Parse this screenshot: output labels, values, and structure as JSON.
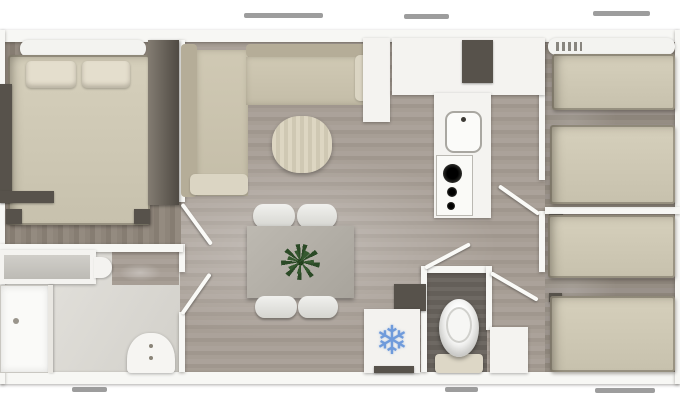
{
  "meta": {
    "description": "Top-down 3D rendered floor plan of a 3-bedroom mobile home",
    "image_kind": "floorplan-render"
  },
  "palette": {
    "wall": "#f7f7f4",
    "floor_wood_light": "#a79e95",
    "floor_wood_master": "#8e857a",
    "floor_wood_right": "#958d83",
    "floor_bathroom": "#e0ded9",
    "floor_wc_dark": "#6b6660",
    "bed_beige": "#d2ccb8",
    "dark_furniture": "#57524b",
    "white_furniture": "#f4f3f0",
    "accent_snowflake_blue": "#6f9bdb",
    "plant_green": "#2e4d2a",
    "window_mark_gray": "#8c8c8c"
  },
  "fridge": {
    "snowflake_glyph": "❄"
  },
  "floorplan": {
    "width": 680,
    "height": 408,
    "rooms": [
      "master-bedroom",
      "bathroom",
      "living-room",
      "dining-area",
      "kitchen",
      "hallway",
      "wc",
      "bedroom-top-right",
      "bedroom-bottom-right"
    ],
    "items": [
      {
        "name": "floor-main-living",
        "cls": "floor-living",
        "x": 5,
        "y": 40,
        "w": 670,
        "h": 332
      },
      {
        "name": "floor-master-bedroom",
        "cls": "floor-master",
        "x": 5,
        "y": 40,
        "w": 176,
        "h": 204
      },
      {
        "name": "floor-bedroom-top-right",
        "cls": "floor-right",
        "x": 545,
        "y": 40,
        "w": 130,
        "h": 168
      },
      {
        "name": "floor-bedroom-bottom-right",
        "cls": "floor-right",
        "x": 545,
        "y": 213,
        "w": 130,
        "h": 159
      },
      {
        "name": "floor-bathroom",
        "cls": "floor-bath",
        "x": 5,
        "y": 251,
        "w": 175,
        "h": 121
      },
      {
        "name": "floor-bathroom-door-patch",
        "cls": "floor-living",
        "x": 112,
        "y": 252,
        "w": 67,
        "h": 33
      },
      {
        "name": "floor-wc",
        "cls": "floor-wc",
        "x": 427,
        "y": 272,
        "w": 60,
        "h": 100
      },
      {
        "name": "wall-top-exterior",
        "cls": "wall",
        "x": 0,
        "y": 30,
        "w": 680,
        "h": 12
      },
      {
        "name": "wall-bottom-exterior",
        "cls": "wall",
        "x": 0,
        "y": 372,
        "w": 680,
        "h": 12
      },
      {
        "name": "wall-left-exterior",
        "cls": "wall",
        "x": 0,
        "y": 30,
        "w": 5,
        "h": 354
      },
      {
        "name": "wall-right-exterior",
        "cls": "wall",
        "x": 675,
        "y": 30,
        "w": 5,
        "h": 354
      },
      {
        "name": "wall-master-hall-upper",
        "cls": "wall",
        "x": 179,
        "y": 40,
        "w": 6,
        "h": 162
      },
      {
        "name": "wall-master-hall-mid",
        "cls": "wall",
        "x": 179,
        "y": 244,
        "w": 6,
        "h": 28
      },
      {
        "name": "wall-master-hall-lower",
        "cls": "wall",
        "x": 179,
        "y": 312,
        "w": 6,
        "h": 60
      },
      {
        "name": "wall-bedroom-bathroom",
        "cls": "wall",
        "x": 0,
        "y": 244,
        "w": 183,
        "h": 8
      },
      {
        "name": "wall-wc-top",
        "cls": "wall",
        "x": 421,
        "y": 266,
        "w": 70,
        "h": 7
      },
      {
        "name": "wall-wc-left",
        "cls": "wall",
        "x": 421,
        "y": 266,
        "w": 6,
        "h": 106
      },
      {
        "name": "wall-wc-right",
        "cls": "wall",
        "x": 486,
        "y": 266,
        "w": 6,
        "h": 64
      },
      {
        "name": "wall-kitchen-bedroom-upper",
        "cls": "wall",
        "x": 539,
        "y": 40,
        "w": 6,
        "h": 140
      },
      {
        "name": "wall-hall-bedroom-mid",
        "cls": "wall",
        "x": 539,
        "y": 211,
        "w": 6,
        "h": 61
      },
      {
        "name": "wall-between-right-bedrooms",
        "cls": "wall",
        "x": 545,
        "y": 207,
        "w": 135,
        "h": 7
      },
      {
        "name": "master-bed-headboard",
        "cls": "shelf",
        "x": 20,
        "y": 40,
        "w": 126,
        "h": 17
      },
      {
        "name": "master-double-bed",
        "cls": "bed",
        "x": 8,
        "y": 55,
        "w": 142,
        "h": 170
      },
      {
        "name": "master-pillow-left",
        "cls": "pillow",
        "x": 26,
        "y": 61,
        "w": 50,
        "h": 27
      },
      {
        "name": "master-pillow-right",
        "cls": "pillow",
        "x": 82,
        "y": 61,
        "w": 48,
        "h": 27
      },
      {
        "name": "master-bed-post-left",
        "cls": "darkunit",
        "x": 6,
        "y": 209,
        "w": 16,
        "h": 15
      },
      {
        "name": "master-bed-post-right",
        "cls": "darkunit",
        "x": 134,
        "y": 209,
        "w": 16,
        "h": 15
      },
      {
        "name": "master-wardrobe",
        "cls": "wardrobe",
        "x": 148,
        "y": 40,
        "w": 31,
        "h": 165
      },
      {
        "name": "master-side-unit",
        "cls": "darkunit",
        "x": 0,
        "y": 84,
        "w": 12,
        "h": 118
      },
      {
        "name": "master-bench",
        "cls": "darkunit",
        "x": 0,
        "y": 191,
        "w": 54,
        "h": 12
      },
      {
        "name": "bathroom-vanity",
        "cls": "white-furn",
        "x": 0,
        "y": 250,
        "w": 96,
        "h": 34
      },
      {
        "name": "bathroom-vanity-top",
        "cls": "counter-top",
        "x": 4,
        "y": 255,
        "w": 86,
        "h": 24
      },
      {
        "name": "bathroom-washbasin-bump",
        "cls": "bump",
        "x": 94,
        "y": 257,
        "w": 18,
        "h": 21
      },
      {
        "name": "shower-tray",
        "cls": "shower",
        "x": 0,
        "y": 285,
        "w": 50,
        "h": 88
      },
      {
        "name": "shower-screen",
        "cls": "screenline",
        "x": 48,
        "y": 285,
        "w": 5,
        "h": 88
      },
      {
        "name": "shower-drain",
        "cls": "dot",
        "x": 13,
        "y": 318,
        "w": 6,
        "h": 6
      },
      {
        "name": "entrance-door-arch",
        "cls": "arch",
        "x": 127,
        "y": 333,
        "w": 48,
        "h": 40
      },
      {
        "name": "sofa-left-backrest",
        "cls": "sofa-back",
        "x": 181,
        "y": 44,
        "w": 16,
        "h": 153
      },
      {
        "name": "sofa-left-seat",
        "cls": "sofa-seat",
        "x": 197,
        "y": 50,
        "w": 51,
        "h": 146
      },
      {
        "name": "sofa-left-armrest",
        "cls": "sofa-arm",
        "x": 190,
        "y": 174,
        "w": 58,
        "h": 21
      },
      {
        "name": "sofa-top-backrest",
        "cls": "sofa-back",
        "x": 246,
        "y": 44,
        "w": 122,
        "h": 13
      },
      {
        "name": "sofa-top-seat",
        "cls": "sofa-seat",
        "x": 246,
        "y": 57,
        "w": 122,
        "h": 48
      },
      {
        "name": "sofa-end-cushion",
        "cls": "sofa-arm",
        "x": 355,
        "y": 55,
        "w": 29,
        "h": 46
      },
      {
        "name": "pantry-cabinet",
        "cls": "white-furn",
        "x": 363,
        "y": 38,
        "w": 27,
        "h": 84
      },
      {
        "name": "pouf-side-table",
        "cls": "pouf",
        "x": 272,
        "y": 116,
        "w": 60,
        "h": 57
      },
      {
        "name": "dining-chair-top-left",
        "cls": "chair",
        "x": 253,
        "y": 204,
        "w": 42,
        "h": 24
      },
      {
        "name": "dining-chair-top-right",
        "cls": "chair",
        "x": 297,
        "y": 204,
        "w": 40,
        "h": 24
      },
      {
        "name": "dining-table",
        "cls": "table",
        "x": 247,
        "y": 226,
        "w": 107,
        "h": 72
      },
      {
        "name": "plant-centerpiece",
        "cls": "plant",
        "x": 283,
        "y": 246,
        "w": 35,
        "h": 32
      },
      {
        "name": "dining-chair-bottom-left",
        "cls": "chair",
        "x": 255,
        "y": 296,
        "w": 42,
        "h": 22
      },
      {
        "name": "dining-chair-bottom-right",
        "cls": "chair",
        "x": 298,
        "y": 296,
        "w": 40,
        "h": 22
      },
      {
        "name": "kitchen-wall-cabinets",
        "cls": "white-furn",
        "x": 392,
        "y": 38,
        "w": 153,
        "h": 57
      },
      {
        "name": "kitchen-appliance",
        "cls": "darkunit",
        "x": 462,
        "y": 40,
        "w": 31,
        "h": 43
      },
      {
        "name": "kitchen-counter",
        "cls": "white-furn",
        "x": 434,
        "y": 93,
        "w": 57,
        "h": 125
      },
      {
        "name": "kitchen-sink",
        "cls": "sink",
        "x": 445,
        "y": 111,
        "w": 37,
        "h": 42
      },
      {
        "name": "kitchen-hob",
        "cls": "hob",
        "x": 436,
        "y": 155,
        "w": 37,
        "h": 61
      },
      {
        "name": "hob-burner-large",
        "cls": "burner",
        "x": 443,
        "y": 164,
        "w": 19,
        "h": 19
      },
      {
        "name": "hob-burner-medium",
        "cls": "burner",
        "x": 447,
        "y": 187,
        "w": 10,
        "h": 10
      },
      {
        "name": "hob-burner-small",
        "cls": "burner",
        "x": 447,
        "y": 202,
        "w": 8,
        "h": 8
      },
      {
        "name": "wc-side-cabinet",
        "cls": "darkunit",
        "x": 394,
        "y": 284,
        "w": 32,
        "h": 27
      },
      {
        "name": "fridge",
        "cls": "fridge",
        "x": 364,
        "y": 309,
        "w": 56,
        "h": 64,
        "glyph_bind": "fridge.snowflake_glyph",
        "glyph_name": "snowflake-icon"
      },
      {
        "name": "fridge-base-strip",
        "cls": "darkunit",
        "x": 374,
        "y": 366,
        "w": 40,
        "h": 7
      },
      {
        "name": "toilet-base",
        "cls": "toilet-base",
        "x": 435,
        "y": 354,
        "w": 48,
        "h": 19
      },
      {
        "name": "toilet",
        "cls": "toilet",
        "x": 439,
        "y": 299,
        "w": 40,
        "h": 58
      },
      {
        "name": "hall-storage-cabinet",
        "cls": "white-furn",
        "x": 490,
        "y": 327,
        "w": 38,
        "h": 46
      },
      {
        "name": "right-bedroom-shelf",
        "cls": "shelf",
        "x": 548,
        "y": 38,
        "w": 127,
        "h": 17
      },
      {
        "name": "right-bedroom-shelf-marks",
        "cls": "mark",
        "x": 556,
        "y": 42,
        "w": 26,
        "h": 9
      },
      {
        "name": "bed-single-top-1",
        "cls": "bed",
        "x": 552,
        "y": 54,
        "w": 123,
        "h": 56
      },
      {
        "name": "bed-single-top-2",
        "cls": "bed",
        "x": 550,
        "y": 125,
        "w": 125,
        "h": 79
      },
      {
        "name": "bed-corner-shadow-1",
        "cls": "darkunit",
        "x": 549,
        "y": 214,
        "w": 14,
        "h": 9
      },
      {
        "name": "bed-single-bottom-1",
        "cls": "bed",
        "x": 548,
        "y": 215,
        "w": 127,
        "h": 63
      },
      {
        "name": "bed-corner-shadow-2",
        "cls": "darkunit",
        "x": 549,
        "y": 293,
        "w": 13,
        "h": 9
      },
      {
        "name": "bed-single-bottom-2",
        "cls": "bed",
        "x": 550,
        "y": 296,
        "w": 125,
        "h": 76
      },
      {
        "name": "door-swing-master-bedroom",
        "cls": "door-swing",
        "x": 182,
        "y": 202,
        "len": 50,
        "angle": 54
      },
      {
        "name": "door-swing-bathroom",
        "cls": "door-swing",
        "x": 182,
        "y": 312,
        "len": 49,
        "angle": -55
      },
      {
        "name": "door-swing-wc",
        "cls": "door-swing",
        "x": 425,
        "y": 266,
        "len": 51,
        "angle": -28
      },
      {
        "name": "door-swing-bedroom-top-right",
        "cls": "door-swing",
        "x": 499,
        "y": 184,
        "len": 49,
        "angle": 35
      },
      {
        "name": "door-swing-bedroom-bottom-right",
        "cls": "door-swing",
        "x": 491,
        "y": 271,
        "len": 54,
        "angle": 30
      },
      {
        "name": "window-top-1",
        "cls": "window-mark",
        "x": 244,
        "y": 13,
        "w": 79,
        "h": 5
      },
      {
        "name": "window-top-2",
        "cls": "window-mark",
        "x": 404,
        "y": 14,
        "w": 45,
        "h": 5
      },
      {
        "name": "window-top-3",
        "cls": "window-mark",
        "x": 593,
        "y": 11,
        "w": 57,
        "h": 5
      },
      {
        "name": "window-bottom-1",
        "cls": "window-mark",
        "x": 72,
        "y": 387,
        "w": 35,
        "h": 5
      },
      {
        "name": "window-bottom-2",
        "cls": "window-mark",
        "x": 445,
        "y": 387,
        "w": 33,
        "h": 5
      },
      {
        "name": "window-bottom-3",
        "cls": "window-mark",
        "x": 595,
        "y": 388,
        "w": 60,
        "h": 5
      }
    ]
  }
}
